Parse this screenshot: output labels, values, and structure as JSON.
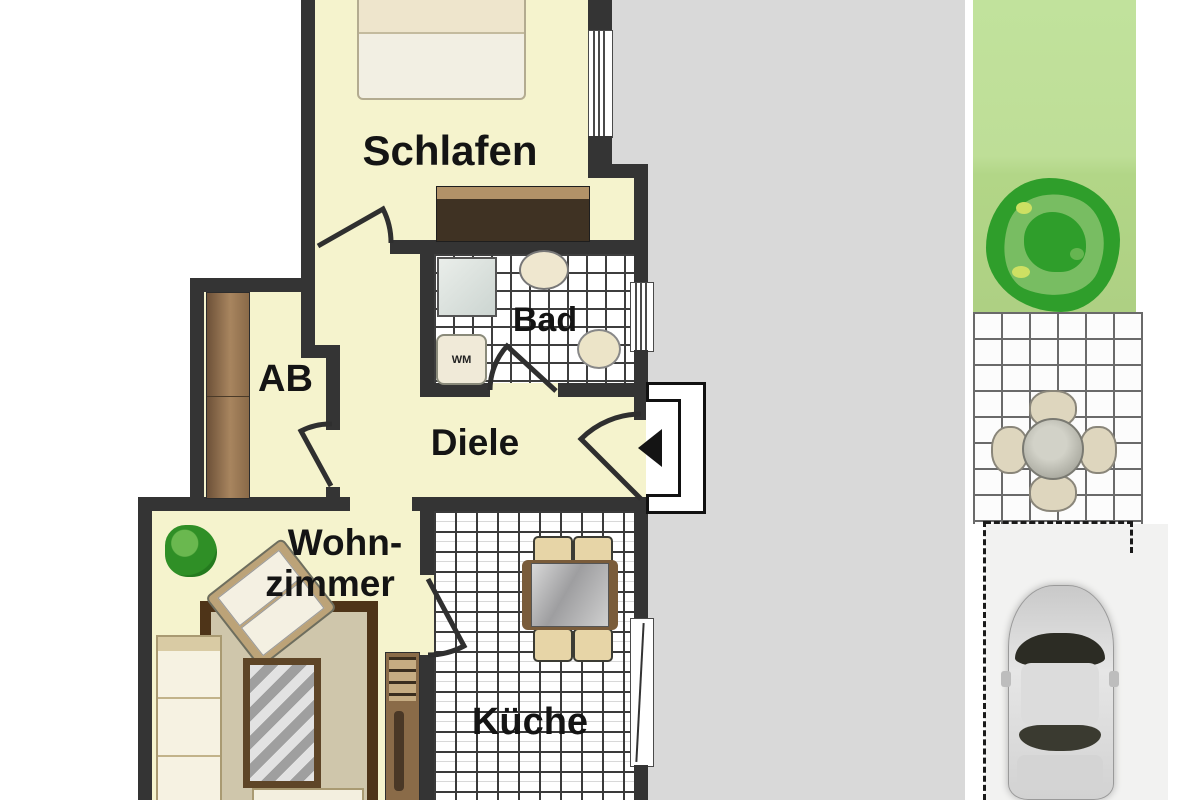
{
  "floorplan": {
    "rooms": {
      "bedroom": {
        "label": "Schlafen"
      },
      "bathroom": {
        "label": "Bad"
      },
      "storage": {
        "label": "AB"
      },
      "hallway": {
        "label": "Diele"
      },
      "living_room": {
        "label_line1": "Wohn-",
        "label_line2": "zimmer"
      },
      "kitchen": {
        "label": "Küche"
      }
    },
    "appliances": {
      "washing_machine_label": "WM"
    },
    "icons": {
      "entrance_arrow": "left-arrow"
    },
    "colors": {
      "wall": "#343434",
      "room_floor": "#f5f3cd",
      "tile_floor": "#ffffff",
      "background_gray": "#d9d9d9",
      "garden_green": "#bede97",
      "bush_green": "#2f9e2b",
      "cabinet_wood": "#9a7a58",
      "wardrobe_dark": "#3f3223",
      "rug_border": "#4e3418",
      "rug_fill": "#cfc6ab",
      "car_body": "#d6d6d6",
      "accent_text": "#141414"
    }
  }
}
